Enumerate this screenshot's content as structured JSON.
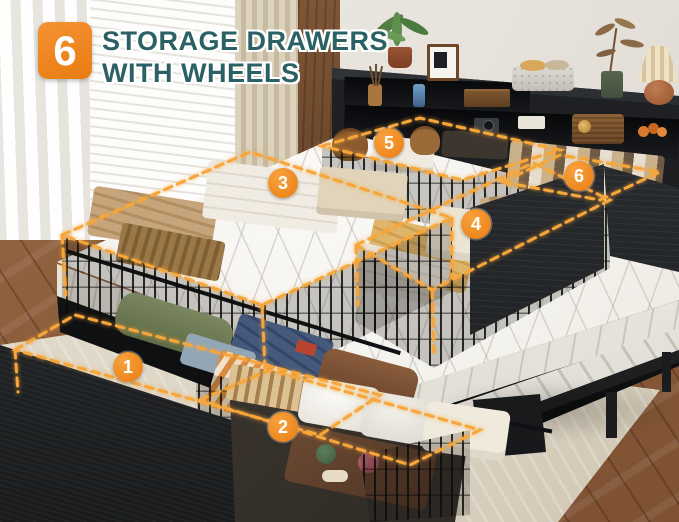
{
  "callout": {
    "count": "6",
    "title_line1": "STORAGE DRAWERS",
    "title_line2": "WITH WHEELS"
  },
  "drawers": [
    {
      "number": "1"
    },
    {
      "number": "2"
    },
    {
      "number": "3"
    },
    {
      "number": "4"
    },
    {
      "number": "5"
    },
    {
      "number": "6"
    }
  ],
  "colors": {
    "accent_orange": "#F08A1E",
    "dash_glow_orange": "#F7A63A",
    "title_teal": "#2B6164",
    "wall": "#E8E4DD",
    "headboard_black": "#1A1C1E",
    "mattress_white": "#F4F2ED",
    "rug_beige": "#DCD4C4",
    "wood_floor_brown": "#8F5E3B"
  },
  "decor": {
    "items": [
      "potted-plant",
      "picture-frame",
      "reed-diffuser",
      "phone",
      "wooden-box",
      "camera",
      "storage-box",
      "fabric-basket",
      "vintage-radio",
      "fruit-bowl",
      "vase-with-branch",
      "table-lamp"
    ]
  }
}
